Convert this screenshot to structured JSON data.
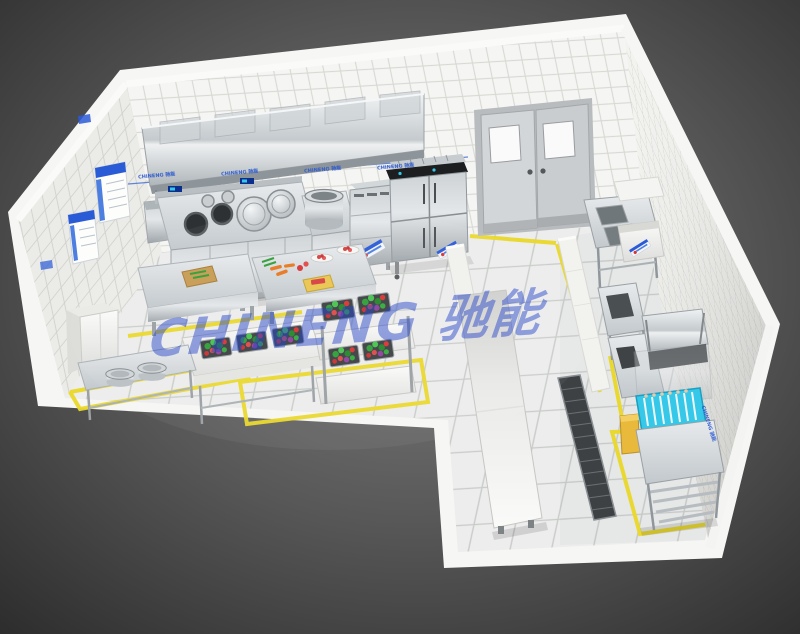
{
  "watermark": {
    "text": "CHINENG 驰能",
    "color": "#2745c8"
  },
  "wall_strip": {
    "labels": [
      "CHINENG 驰能",
      "CHINENG 驰能",
      "CHINENG 驰能",
      "CHINENG 驰能"
    ]
  },
  "right_wall_label": "CHINENG 驰能",
  "palette": {
    "background_dark": "#2e2e2e",
    "background_light": "#7a7a7a",
    "wall_tile": "#f4f4f2",
    "grout": "#d2d2ce",
    "floor": "#ecedec",
    "floor_line_yellow": "#ead829",
    "steel_light": "#e9ecee",
    "steel_mid": "#c3c9cd",
    "steel_dark": "#8f979c",
    "accent_blue": "#2a5bd7",
    "dish_rack_cyan": "#35c8e8",
    "veg_green": "#37a93c",
    "veg_red": "#d63434",
    "door_gray": "#cdd0d2",
    "trash_yellow": "#e8b93a"
  },
  "scene": {
    "objects": [
      "exhaust-hood",
      "wok-range",
      "stock-pot-station",
      "steam-cabinet",
      "four-door-refrigerator",
      "double-swing-doors",
      "hand-sink",
      "prep-table",
      "vegetable-sink-table",
      "vegetable-rack",
      "pot-table",
      "storage-cabinet",
      "pass-counter",
      "partition-wall",
      "pre-rinse-sink",
      "wall-shelf",
      "sorting-table",
      "hood-dishwasher",
      "dish-rack",
      "clean-dish-table",
      "floor-drain",
      "trash-bin",
      "wall-posters",
      "floor-safety-lines"
    ]
  }
}
